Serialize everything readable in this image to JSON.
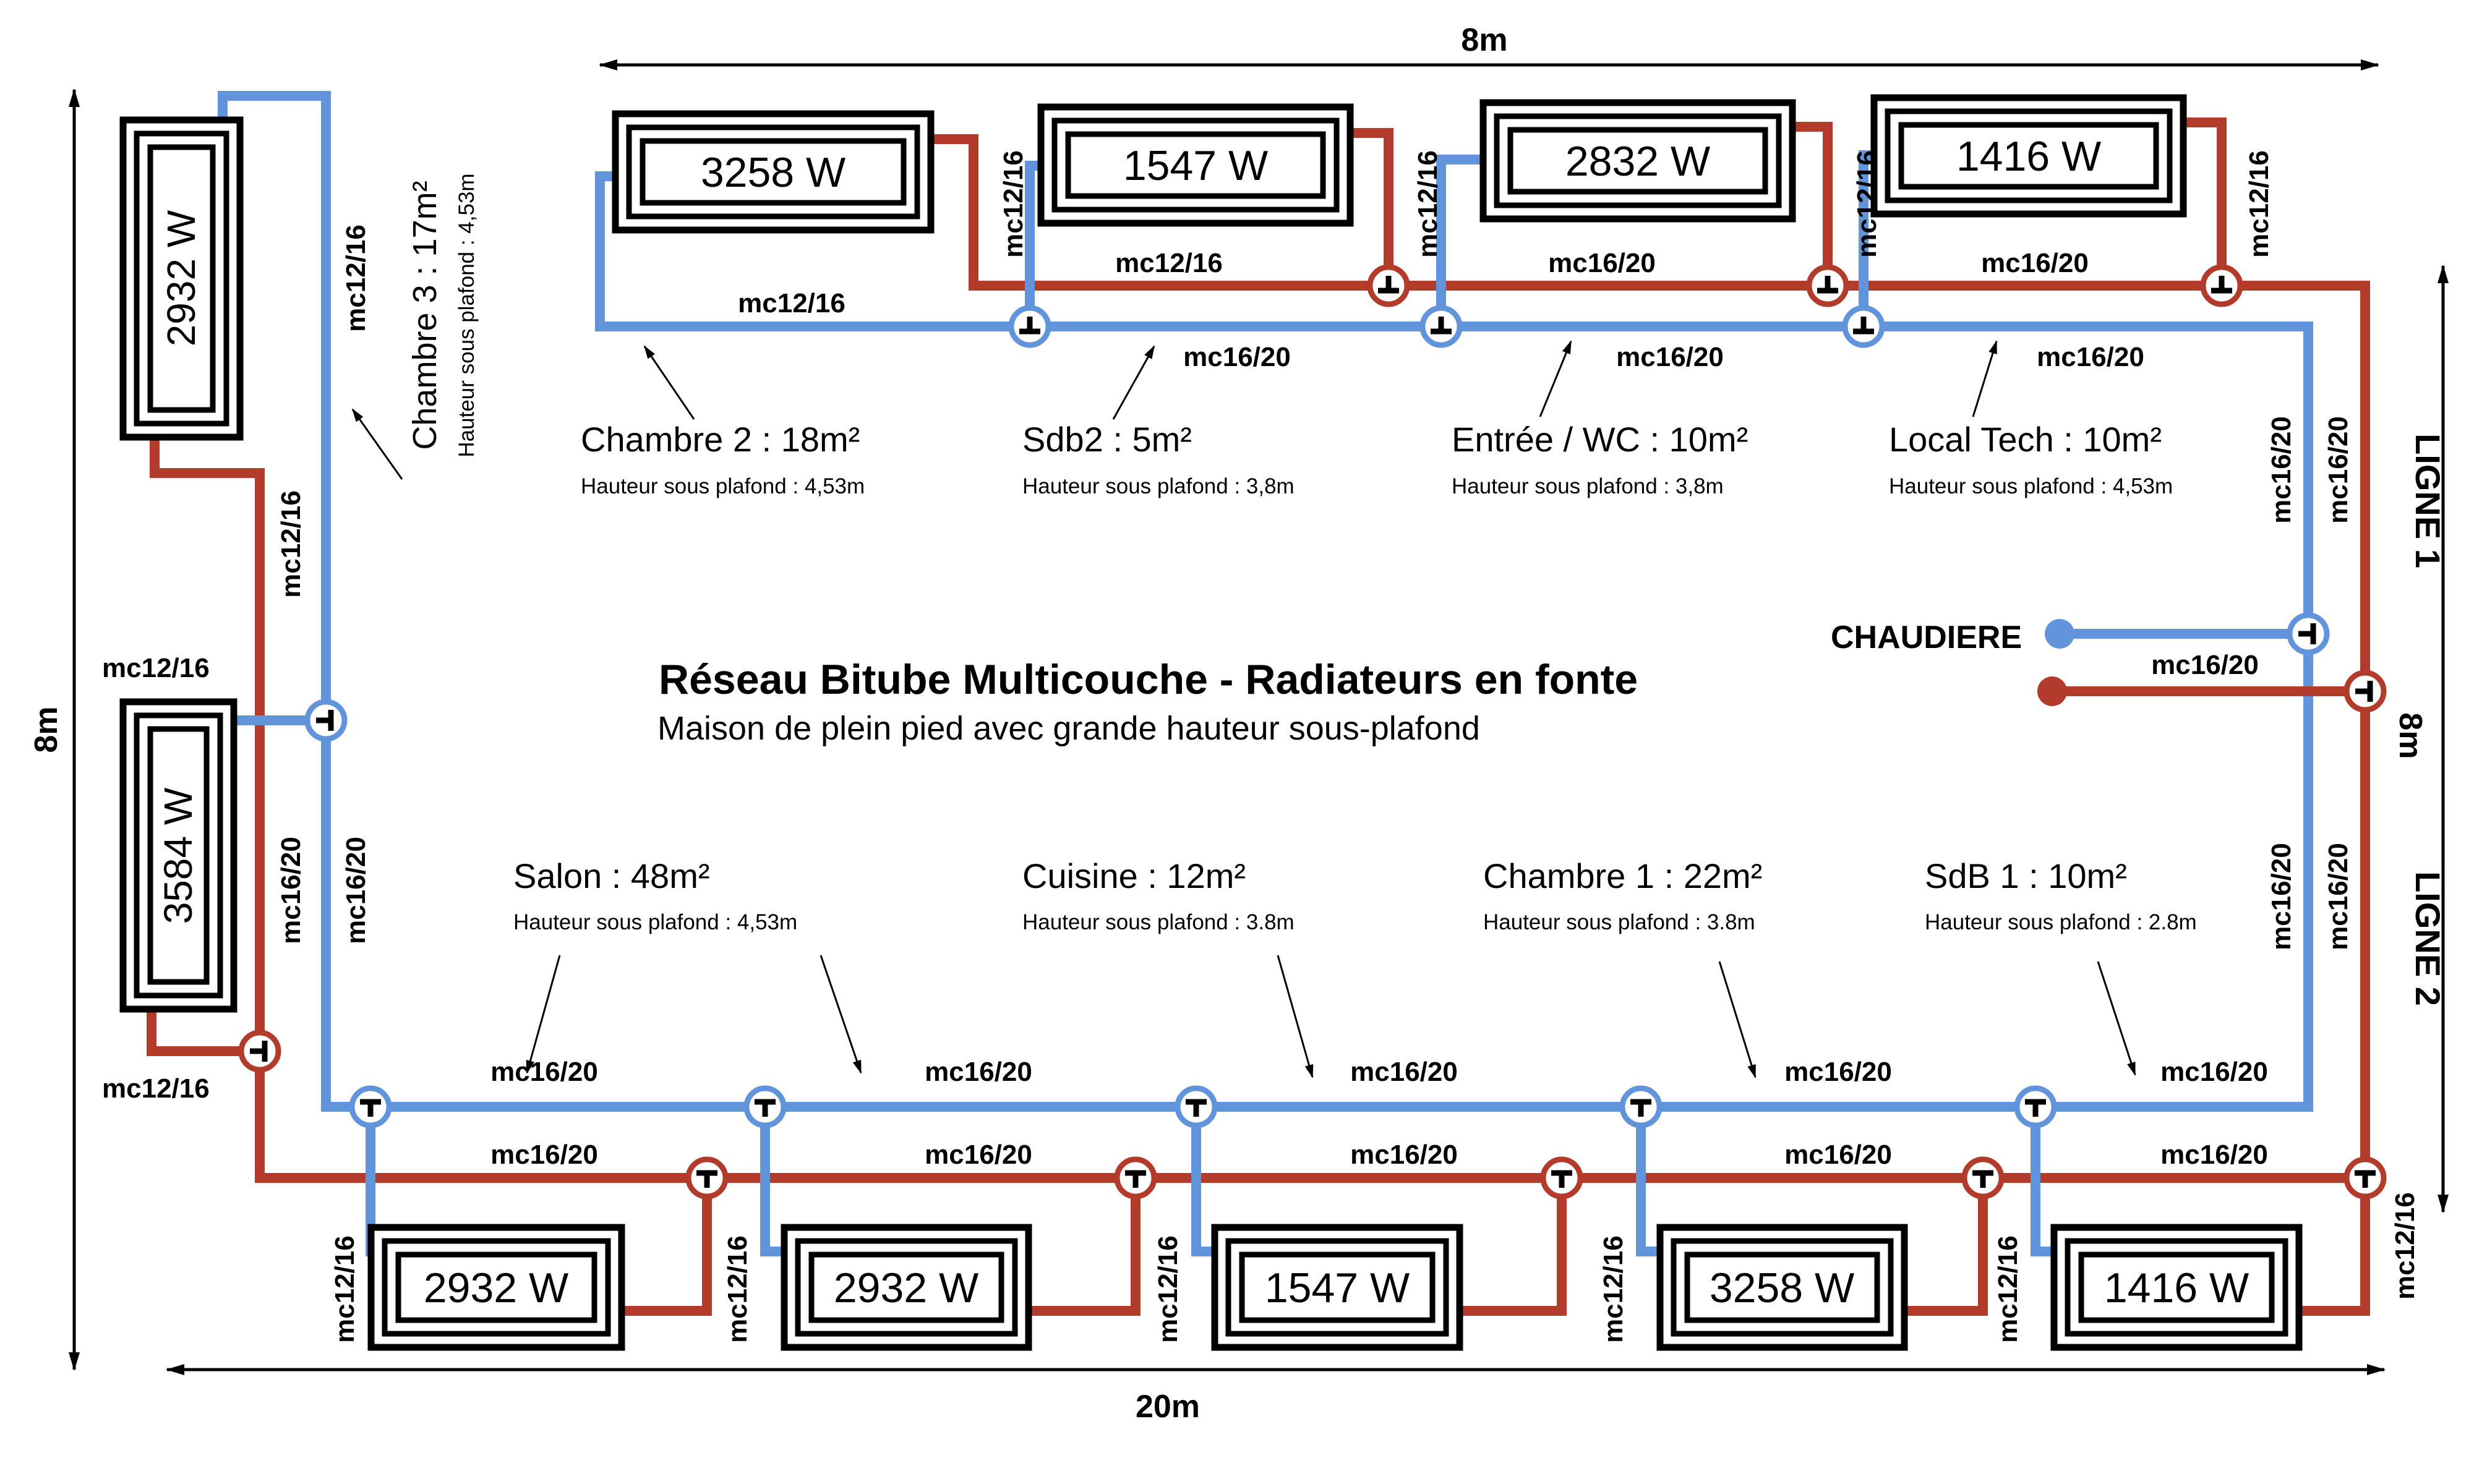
{
  "title": {
    "main": "Réseau Bitube Multicouche - Radiateurs en fonte",
    "subtitle": "Maison de plein pied avec grande hauteur sous-plafond"
  },
  "boiler": {
    "label": "CHAUDIERE"
  },
  "lines": {
    "line1": "LIGNE 1",
    "line2": "LIGNE 2"
  },
  "pipes": {
    "small": "mc12/16",
    "large": "mc16/20"
  },
  "dimensions": {
    "top": "8m",
    "left": "8m",
    "right": "8m",
    "bottom": "20m"
  },
  "rooms": {
    "chambre3": {
      "name": "Chambre 3 : 17m²",
      "height": "Hauteur sous plafond : 4,53m"
    },
    "chambre2": {
      "name": "Chambre 2 : 18m²",
      "height": "Hauteur sous plafond : 4,53m"
    },
    "sdb2": {
      "name": "Sdb2 : 5m²",
      "height": "Hauteur sous plafond : 3,8m"
    },
    "entree": {
      "name": "Entrée / WC : 10m²",
      "height": "Hauteur sous plafond : 3,8m"
    },
    "localtech": {
      "name": "Local Tech : 10m²",
      "height": "Hauteur sous plafond : 4,53m"
    },
    "salon": {
      "name": "Salon : 48m²",
      "height": "Hauteur sous plafond : 4,53m"
    },
    "cuisine": {
      "name": "Cuisine : 12m²",
      "height": "Hauteur sous plafond : 3.8m"
    },
    "chambre1": {
      "name": "Chambre 1 : 22m²",
      "height": "Hauteur sous plafond : 3.8m"
    },
    "sdb1": {
      "name": "SdB 1 : 10m²",
      "height": "Hauteur sous plafond : 2.8m"
    }
  },
  "radiators": {
    "left_top": "2932 W",
    "left_mid": "3584 W",
    "top": [
      "3258 W",
      "1547 W",
      "2832 W",
      "1416 W"
    ],
    "bottom": [
      "2932 W",
      "2932 W",
      "1547 W",
      "3258 W",
      "1416 W"
    ]
  },
  "colors": {
    "supply": "#b23b2b",
    "return": "#6194db"
  }
}
